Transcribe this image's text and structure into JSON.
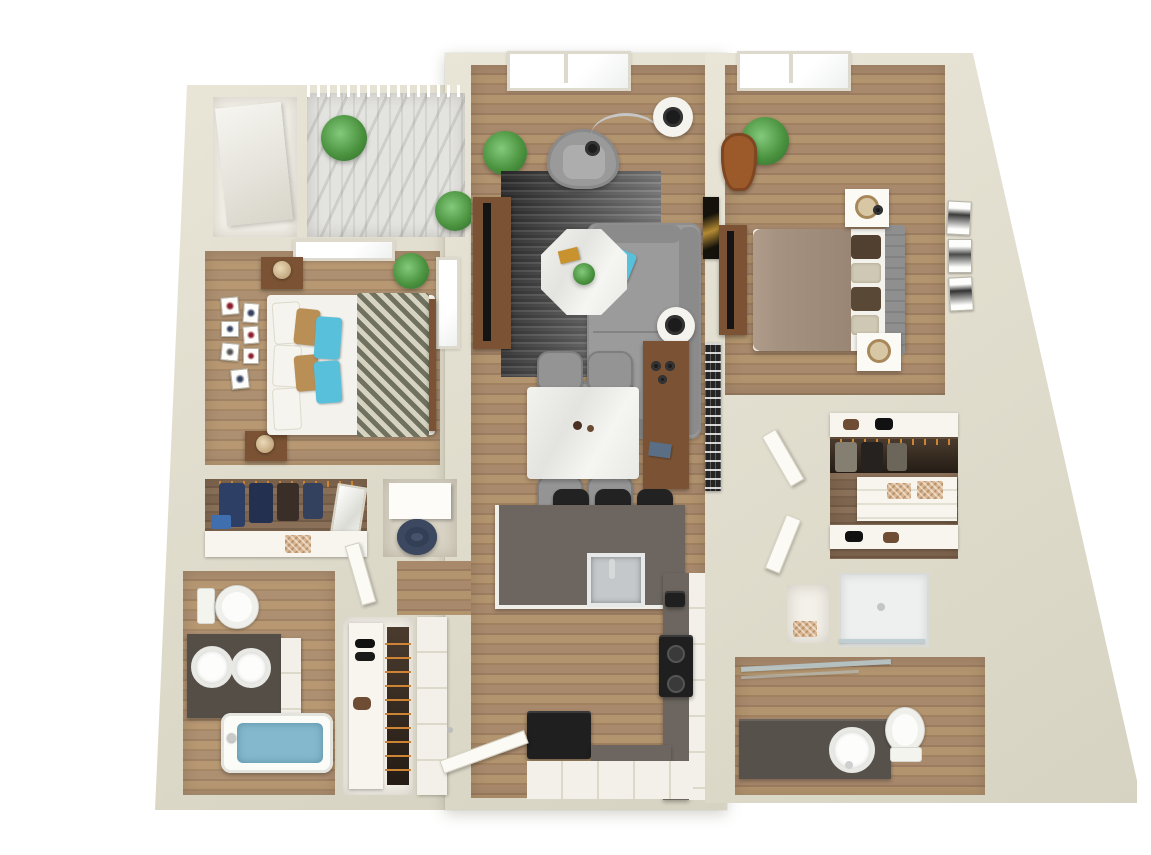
{
  "floor_plan": {
    "title": "Two-bedroom, two-bath apartment 3D floor plan",
    "style": "3D top-down render on white background",
    "bedrooms": 2,
    "bathrooms": 2,
    "balcony": true
  },
  "palette": {
    "wall": "#e9e5d7",
    "wallEdge": "#d7d3c2",
    "woodFurniture": "#7b5334",
    "counter": "#6d6660",
    "cabinet": "#f2f0e8",
    "sofa": "#9b9b9b",
    "teal": "#58c0da",
    "taupe": "#a69280",
    "headboard": "#8f8f8f",
    "leather": "#9c5a2b",
    "green": "#4c9440",
    "heater": "#47536c",
    "hanger": "#cd8434",
    "water": "#84b8cd",
    "marble": "#efefec",
    "deck": "#e3e3e0",
    "appliance": "#1f1f1f",
    "chevron": "#70715f"
  },
  "rooms": [
    {
      "id": "balcony",
      "label": "Balcony",
      "items": [
        "slatted deck",
        "white railing",
        "pergola shade",
        "potted plant"
      ]
    },
    {
      "id": "storage-closet",
      "label": "Storage closet",
      "items": [
        "angled storage unit"
      ]
    },
    {
      "id": "bedroom-1",
      "label": "Bedroom 1",
      "items": [
        "bed with chevron duvet",
        "white, tan and teal pillows",
        "two wood nightstands with lamps",
        "gallery wall of seven frames",
        "window to balcony",
        "pass-through window",
        "potted plants"
      ]
    },
    {
      "id": "walk-in-closet-1",
      "label": "Walk-in closet 1",
      "items": [
        "hanging clothes",
        "leaning mirror",
        "shelf with basket"
      ]
    },
    {
      "id": "utility-closet",
      "label": "Utility closet",
      "items": [
        "white cabinet",
        "water heater"
      ]
    },
    {
      "id": "bathroom-1",
      "label": "Bathroom 1",
      "items": [
        "toilet",
        "dark double-sink vanity",
        "bathtub with water"
      ]
    },
    {
      "id": "entry-closet",
      "label": "Entry closet",
      "items": [
        "shoe shelf",
        "hanging rod with clothes"
      ]
    },
    {
      "id": "living-room",
      "label": "Living room",
      "items": [
        "gray sofa with two teal pillows",
        "two barrel armchairs",
        "octagonal marble coffee table",
        "striped gray rug",
        "media console with TV",
        "arc floor lamp",
        "two marble side tables with black lamps",
        "picture window",
        "potted plants",
        "gold wall art"
      ]
    },
    {
      "id": "dining-area",
      "label": "Dining area",
      "items": [
        "marble dining table",
        "four gray chairs",
        "wood sideboard",
        "patterned wall art"
      ]
    },
    {
      "id": "kitchen",
      "label": "Kitchen",
      "items": [
        "island with stainless sink",
        "three black bar stools",
        "L-shaped counter with white cabinets",
        "black range with burners",
        "black refrigerator",
        "entry door"
      ]
    },
    {
      "id": "bedroom-2",
      "label": "Bedroom 2",
      "items": [
        "bed with taupe duvet",
        "gray tufted headboard",
        "two white nightstands with lamps",
        "dresser with TV",
        "leather accent chair",
        "monstera plant",
        "three wall frames",
        "skylight window"
      ]
    },
    {
      "id": "walk-in-closet-2",
      "label": "Walk-in closet 2",
      "items": [
        "shoe shelves",
        "hanging rods with clothes",
        "white shelving with baskets"
      ]
    },
    {
      "id": "shower",
      "label": "Walk-in shower",
      "items": [
        "glass panel",
        "glass door"
      ]
    },
    {
      "id": "bathroom-2",
      "label": "Bathroom 2",
      "items": [
        "dark single-sink vanity",
        "toilet",
        "glass shower door"
      ]
    },
    {
      "id": "hallway",
      "label": "Hallway",
      "items": [
        "white paneled doors"
      ]
    }
  ]
}
